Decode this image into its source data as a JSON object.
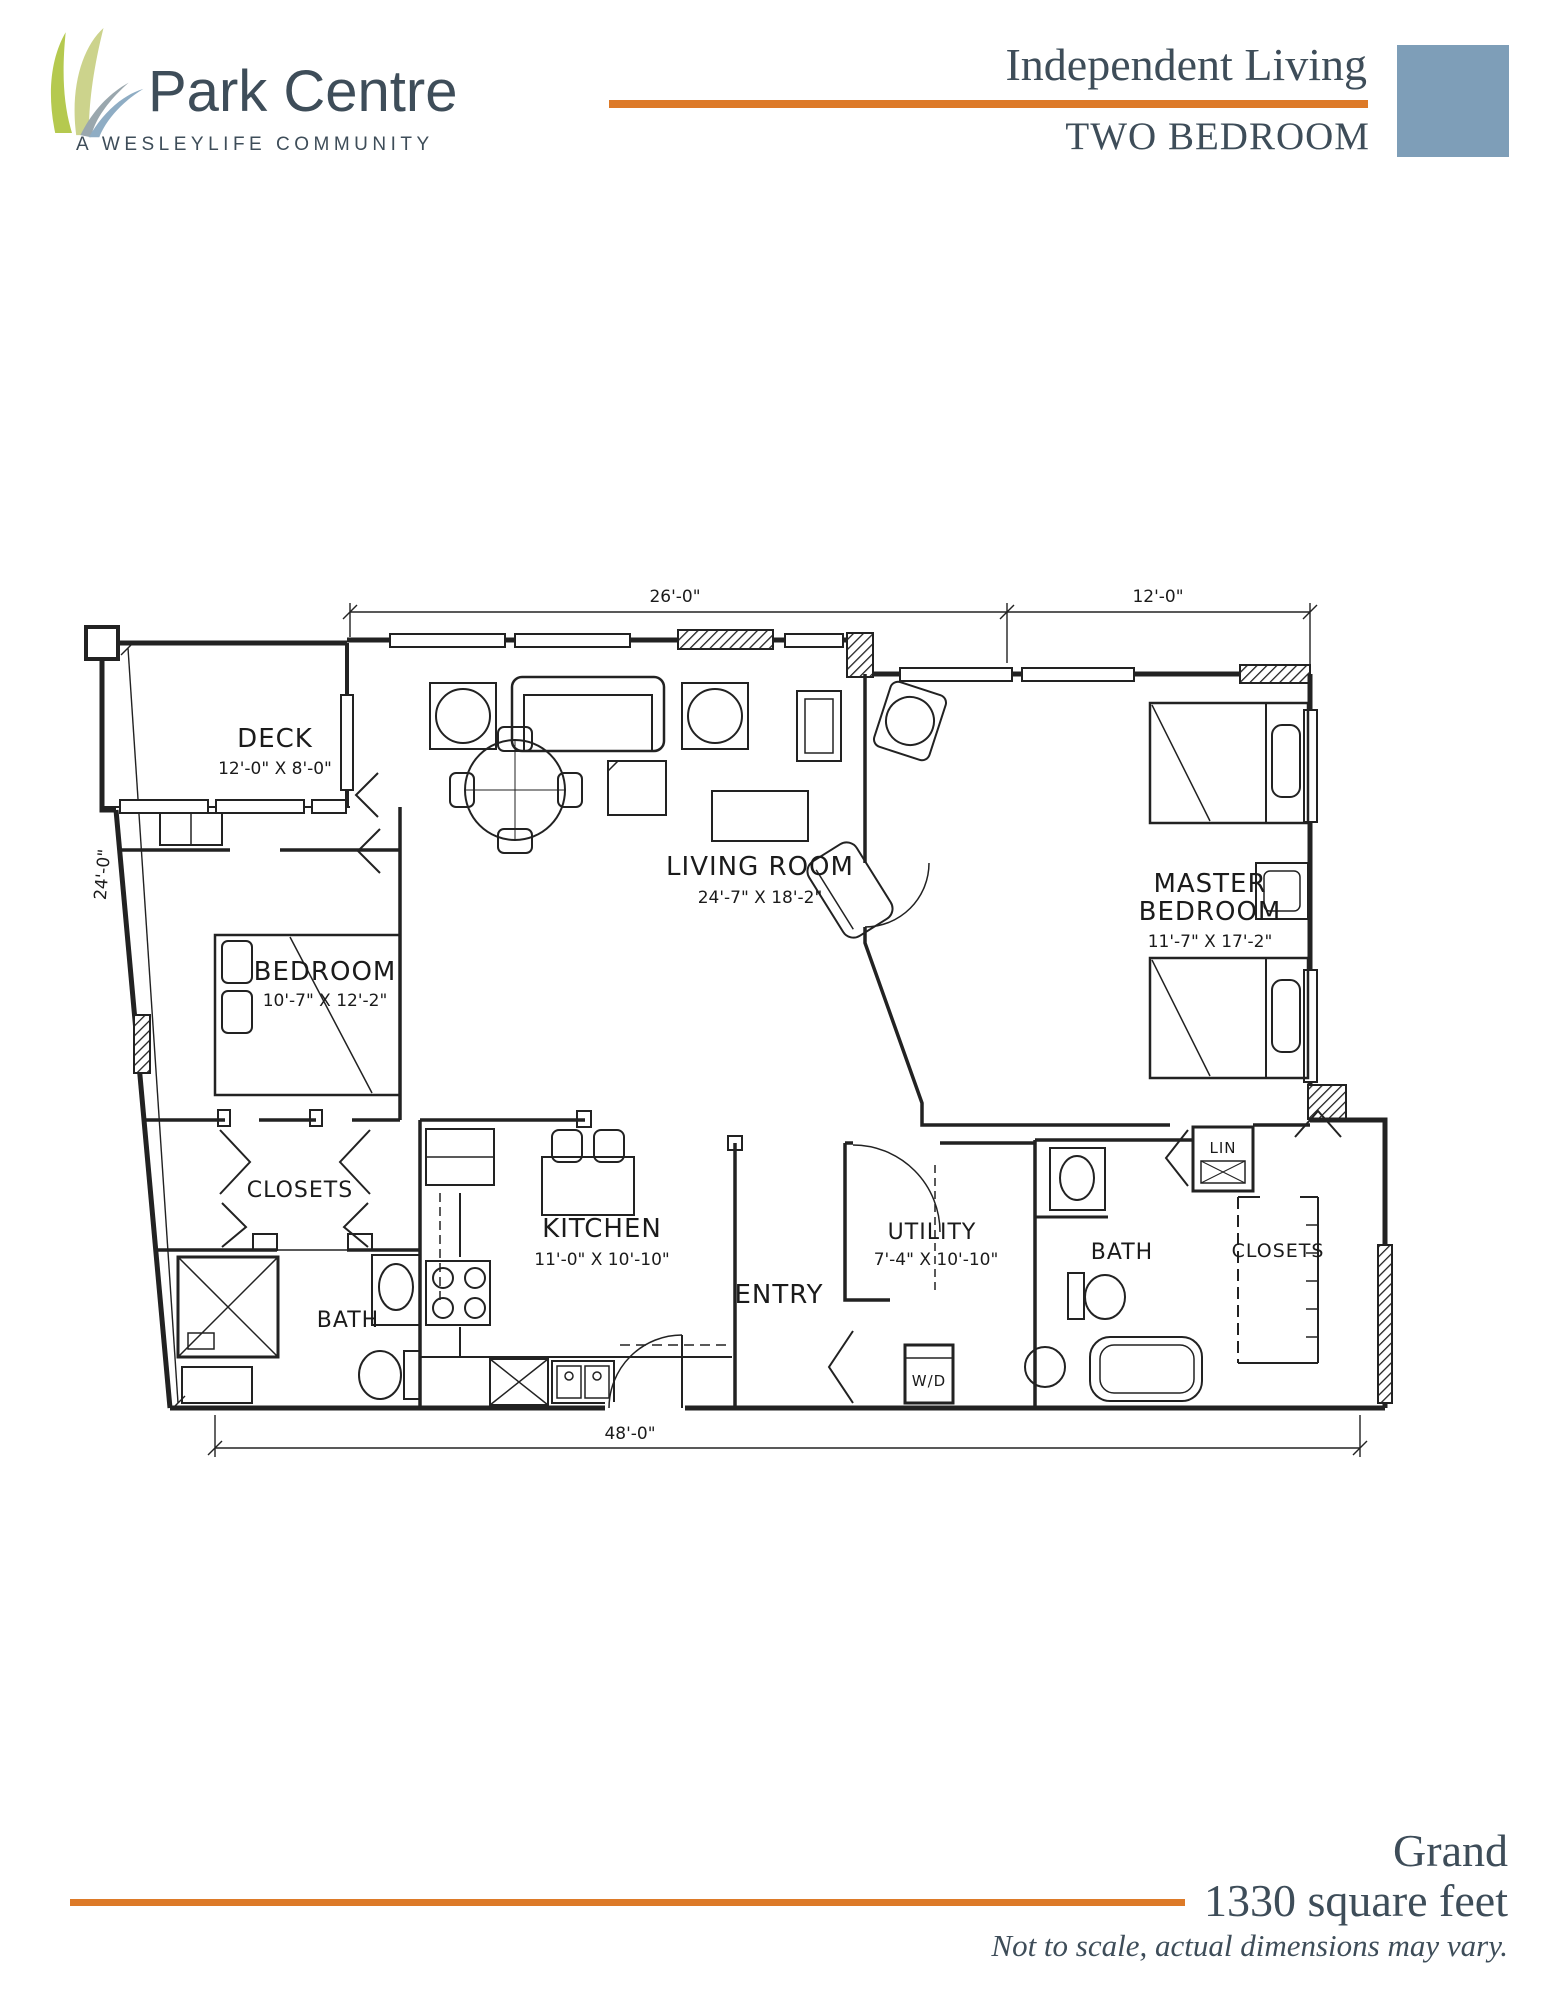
{
  "header": {
    "brand": "Park Centre",
    "tagline": "A WESLEYLIFE COMMUNITY",
    "program": "Independent Living",
    "unit_type": "TWO BEDROOM"
  },
  "floor_plan": {
    "dimensions": {
      "top_left": "26'-0\"",
      "top_right": "12'-0\"",
      "left": "24'-0\"",
      "bottom": "48'-0\""
    },
    "rooms": {
      "deck": {
        "name": "DECK",
        "size": "12'-0\" X 8'-0\""
      },
      "living_room": {
        "name": "LIVING ROOM",
        "size": "24'-7\" X 18'-2\""
      },
      "master_bedroom": {
        "name_line1": "MASTER",
        "name_line2": "BEDROOM",
        "size": "11'-7\" X 17'-2\""
      },
      "bedroom": {
        "name": "BEDROOM",
        "size": "10'-7\" X 12'-2\""
      },
      "kitchen": {
        "name": "KITCHEN",
        "size": "11'-0\" X 10'-10\""
      },
      "utility": {
        "name": "UTILITY",
        "size": "7'-4\" X 10'-10\""
      },
      "entry": {
        "name": "ENTRY"
      },
      "bath_left": {
        "name": "BATH"
      },
      "bath_right": {
        "name": "BATH"
      },
      "closets_left": {
        "name": "CLOSETS"
      },
      "closets_right": {
        "name": "CLOSETS"
      },
      "linen": {
        "name": "LIN"
      },
      "washer_dryer": {
        "name": "W/D"
      }
    }
  },
  "footer": {
    "plan_name": "Grand",
    "area": "1330 square feet",
    "disclaimer": "Not to scale, actual dimensions may vary."
  },
  "colors": {
    "accent_orange": "#dd7a28",
    "slate_text": "#3e4d59",
    "blue_square": "#7e9eb8",
    "ink": "#222222"
  }
}
